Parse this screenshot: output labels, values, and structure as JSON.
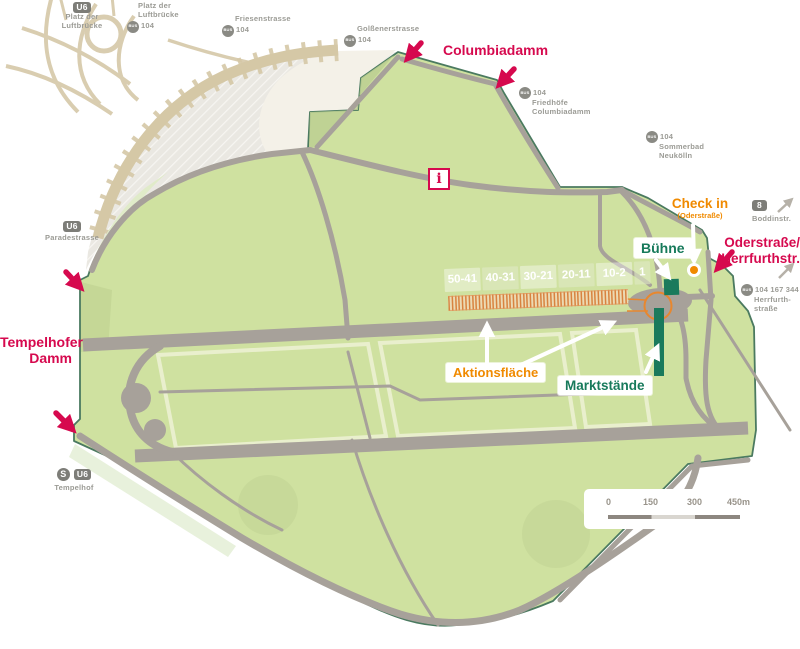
{
  "colors": {
    "entrance_pink": "#d6094e",
    "checkin_orange": "#f08a00",
    "market_green": "#177a5b",
    "field_green": "#cfe1a0",
    "road_gray": "#a7a19a",
    "station_gray": "#9b9b95"
  },
  "stations": {
    "u6_platz": {
      "badge": "U6",
      "line1": "Platz der",
      "line2": "Luftbrücke"
    },
    "bus_platz": {
      "badge": "BUS",
      "route": "104",
      "line1": "Platz der",
      "line2": "Luftbrücke"
    },
    "bus_friesen": {
      "badge": "BUS",
      "route": "104",
      "name": "Friesenstrasse"
    },
    "bus_golssener": {
      "badge": "BUS",
      "route": "104",
      "name": "Golßenerstrasse"
    },
    "bus_friedhoefe": {
      "badge": "BUS",
      "route": "104",
      "line1": "Friedhöfe",
      "line2": "Columbiadamm"
    },
    "bus_sommerbad": {
      "badge": "BUS",
      "route": "104",
      "line1": "Sommerbad",
      "line2": "Neukölln"
    },
    "u8_boddin": {
      "badge": "8",
      "name": "Boddinstr."
    },
    "bus_herrfurth": {
      "badge": "BUS",
      "route": "104 167 344",
      "line1": "Herrfurth-",
      "line2": "straße"
    },
    "u6_parade": {
      "badge": "U6",
      "name": "Paradestrasse"
    },
    "tempelhof": {
      "badge_s": "S",
      "badge_u": "U6",
      "name": "Tempelhof"
    }
  },
  "entrances": {
    "columbiadamm": "Columbiadamm",
    "tempelhofer_damm_line1": "Tempelhofer",
    "tempelhofer_damm_line2": "Damm",
    "oderstrasse_line1": "Oderstraße/",
    "oderstrasse_line2": "Herrfurthstr."
  },
  "checkin": {
    "title": "Check in",
    "subtitle": "(Oderstraße)"
  },
  "market": {
    "stage_label": "Bühne",
    "stalls_label": "Marktstände",
    "action_label": "Aktionsfläche",
    "sections": [
      "50-41",
      "40-31",
      "30-21",
      "20-11",
      "10-2",
      "1"
    ]
  },
  "info": {
    "symbol": "i"
  },
  "scalebar": {
    "t0": "0",
    "t150": "150",
    "t300": "300",
    "t450": "450m"
  }
}
